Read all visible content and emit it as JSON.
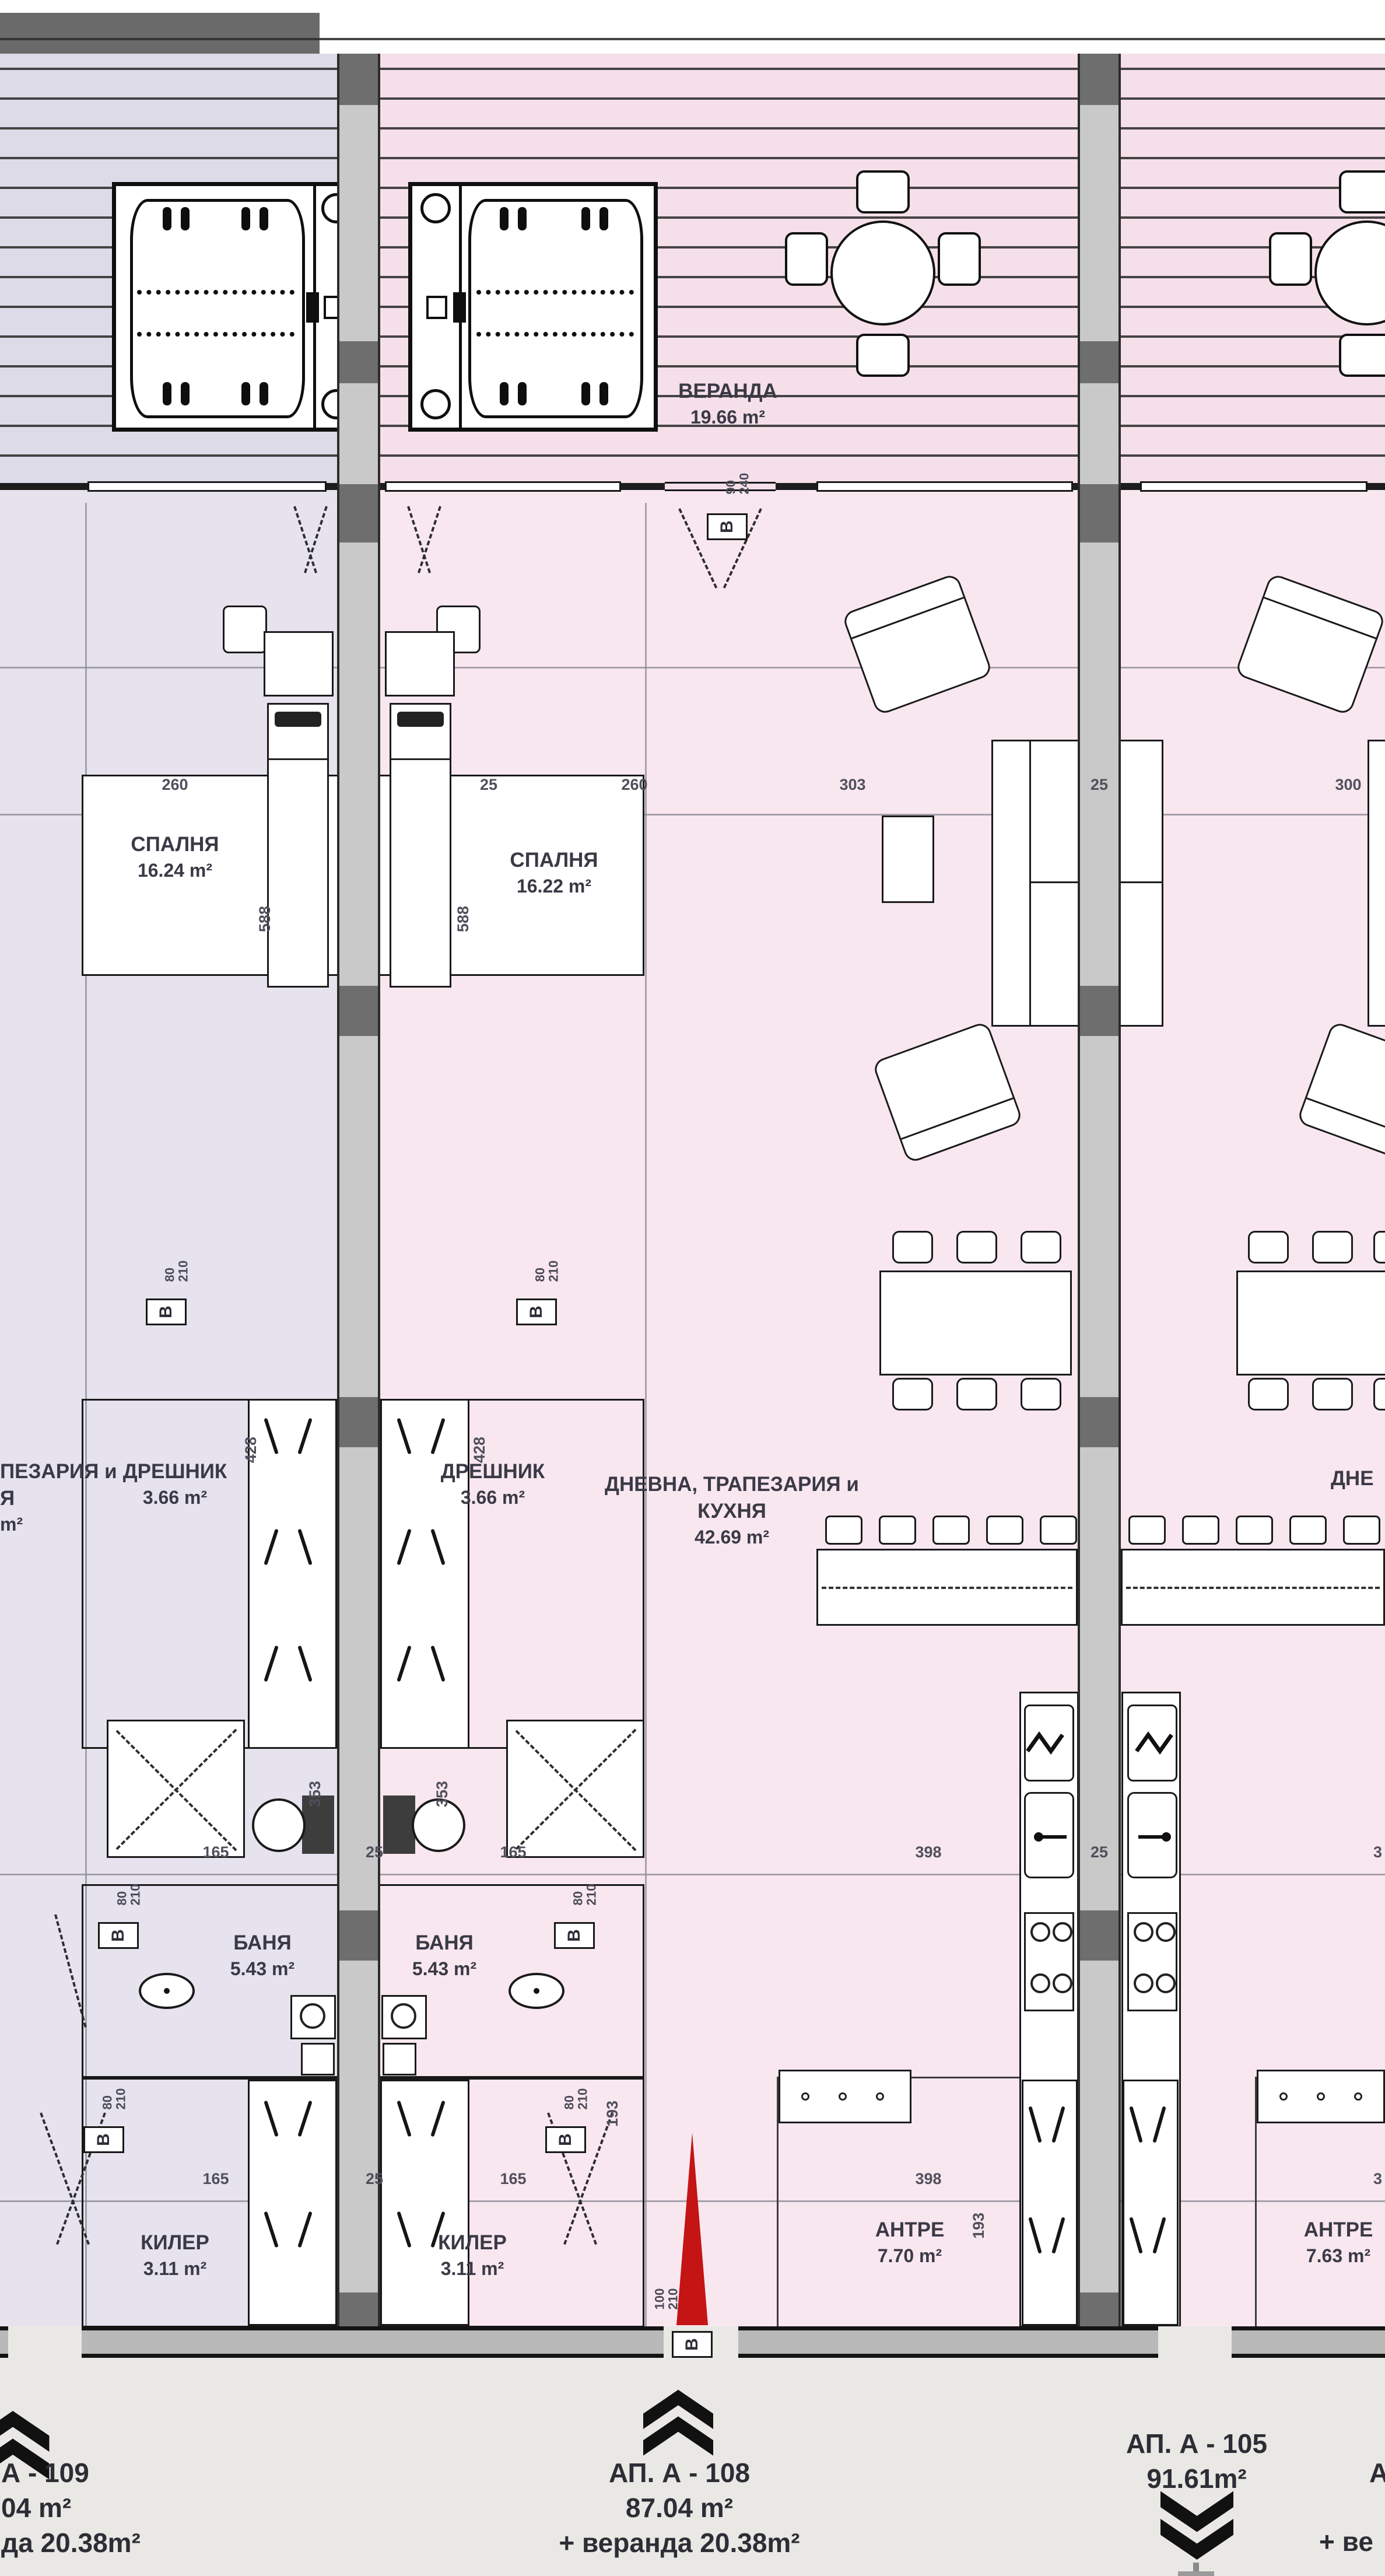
{
  "veranda": {
    "name": "ВЕРАНДА",
    "area": "19.66 m²"
  },
  "rooms": {
    "bedroom_109": {
      "name": "СПАЛНЯ",
      "area": "16.24 m²"
    },
    "bedroom_108": {
      "name": "СПАЛНЯ",
      "area": "16.22 m²"
    },
    "closet_109": {
      "name": "ДРЕШНИК",
      "area": "3.66 m²"
    },
    "closet_108": {
      "name": "ДРЕШНИК",
      "area": "3.66 m²"
    },
    "living_108": {
      "line1": "ДНЕВНА, ТРАПЕЗАРИЯ и",
      "line2": "КУХНЯ",
      "area": "42.69 m²"
    },
    "bath_109": {
      "name": "БАНЯ",
      "area": "5.43 m²"
    },
    "bath_108": {
      "name": "БАНЯ",
      "area": "5.43 m²"
    },
    "storage_109": {
      "name": "КИЛЕР",
      "area": "3.11 m²"
    },
    "storage_108": {
      "name": "КИЛЕР",
      "area": "3.11 m²"
    },
    "entry_108": {
      "name": "АНТРЕ",
      "area": "7.70 m²"
    },
    "entry_105": {
      "name": "АНТРЕ",
      "area": "7.63 m²"
    }
  },
  "fragments": {
    "left_living_line1": "ПЕЗАРИЯ и",
    "left_living_line2": "Я",
    "left_living_line3": "m²",
    "right_living": "ДНЕ",
    "right_apt_line1": "А",
    "right_apt_line2": "+ ве"
  },
  "apartments": {
    "a109": {
      "line1": "А - 109",
      "line2": "04 m²",
      "line3": "да 20.38m²"
    },
    "a108": {
      "line1": "АП. А - 108",
      "line2": "87.04 m²",
      "line3": "+ веранда 20.38m²"
    },
    "a105": {
      "line1": "АП. А - 105",
      "line2": "91.61m²"
    }
  },
  "dims": {
    "top": [
      "260",
      "25",
      "260",
      "303",
      "25",
      "300"
    ],
    "mid": [
      "165",
      "25",
      "165",
      "398",
      "25",
      "3"
    ],
    "bottom": [
      "165",
      "25",
      "165",
      "398",
      "3"
    ],
    "v588": "588",
    "v428": "428",
    "v353": "353",
    "v193": "193"
  },
  "door_tags": {
    "letter": "В",
    "t80": {
      "w": "80",
      "h": "210"
    },
    "t100": {
      "w": "100",
      "h": "210"
    },
    "t90": {
      "w": "90",
      "h": "240"
    }
  }
}
